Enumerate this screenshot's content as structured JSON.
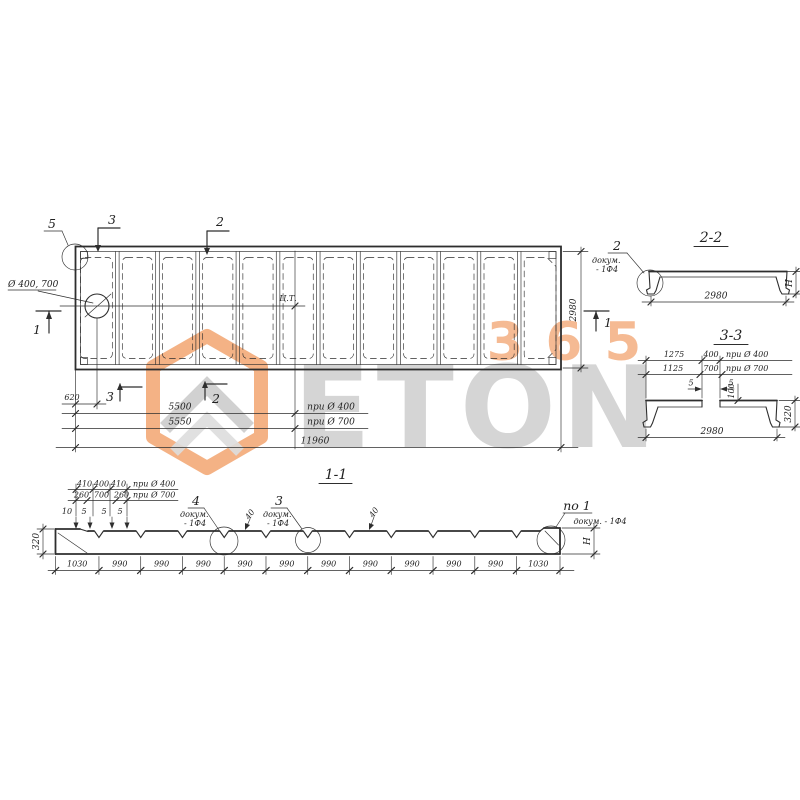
{
  "watermark": {
    "word": "ETON",
    "number": "365",
    "orange": "#f2a470",
    "gray": "#cbcbcb"
  },
  "plan": {
    "hole_label": "Ø 400, 700",
    "cg_label": "Ц.Т.",
    "marker_5": "5",
    "marker_3_top": "3",
    "marker_2_top": "2",
    "marker_1_left": "1",
    "marker_1_right": "1",
    "marker_3_bottom": "3",
    "marker_2_bottom": "2",
    "dim_620": "620",
    "dim_5500": "5500",
    "dim_5550": "5550",
    "cond_d400": "при Ø 400",
    "cond_d700": "при Ø 700",
    "dim_total": "11960",
    "dim_width": "2980"
  },
  "section_2_2": {
    "title": "2-2",
    "callout_number": "2",
    "callout_doc_1": "докум.",
    "callout_doc_2": "- 1Ф4",
    "dim_width": "2980",
    "dim_height": "H"
  },
  "section_3_3": {
    "title": "3-3",
    "dim_1275": "1275",
    "dim_400": "400",
    "cond_d400": "при Ø 400",
    "dim_1125": "1125",
    "dim_700": "700",
    "cond_d700": "при Ø 700",
    "dim_5_left": "5",
    "dim_5_right": "5",
    "dim_100": "100",
    "dim_320": "320",
    "dim_width": "2980"
  },
  "section_1_1": {
    "title": "1-1",
    "top_row1": [
      "410",
      "400",
      "410"
    ],
    "top_row1_cond": "при Ø 400",
    "top_row2": [
      "260",
      "700",
      "260"
    ],
    "top_row2_cond": "при Ø 700",
    "small_dims": [
      "10",
      "5",
      "5",
      "5"
    ],
    "dim_height_left": "320",
    "callout_4": {
      "number": "4",
      "doc_1": "докум.",
      "doc_2": "- 1Ф4"
    },
    "callout_3": {
      "number": "3",
      "doc_1": "докум.",
      "doc_2": "- 1Ф4"
    },
    "dim_40_a": "40",
    "dim_40_b": "40",
    "callout_end": {
      "number": "по 1",
      "doc": "докум. - 1Ф4"
    },
    "dim_height_right": "H",
    "bottom_dims": [
      "1030",
      "990",
      "990",
      "990",
      "990",
      "990",
      "990",
      "990",
      "990",
      "990",
      "990",
      "1030"
    ]
  }
}
